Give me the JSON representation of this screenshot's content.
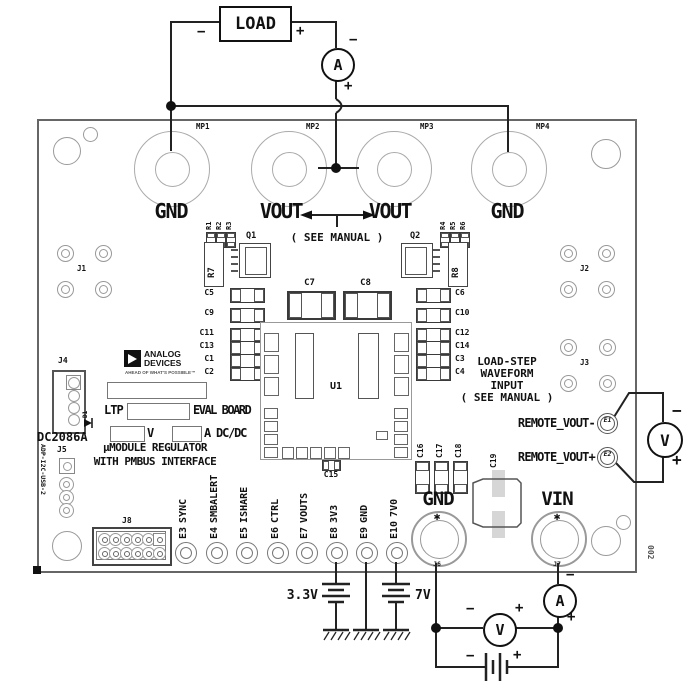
{
  "external_circuit": {
    "load_label": "LOAD",
    "load_minus": "−",
    "load_plus": "+",
    "top_ammeter": {
      "letter": "A",
      "minus": "−",
      "plus": "+"
    },
    "remote_voltmeter": {
      "letter": "V",
      "minus": "−",
      "plus": "+"
    },
    "input_voltmeter": {
      "letter": "V",
      "minus": "−",
      "plus": "+"
    },
    "input_ammeter": {
      "letter": "A",
      "minus": "−",
      "plus": "+"
    },
    "input_battery": {
      "minus": "−",
      "plus": "+"
    },
    "rail_33": "3.3V",
    "rail_7": "7V"
  },
  "board": {
    "rev": "002",
    "power_terminals": [
      {
        "ref": "MP1",
        "label": "GND"
      },
      {
        "ref": "MP2",
        "label": "VOUT"
      },
      {
        "ref": "MP3",
        "label": "VOUT"
      },
      {
        "ref": "MP4",
        "label": "GND"
      }
    ],
    "see_manual": "( SEE MANUAL )",
    "resistors_left": [
      "R1",
      "R2",
      "R3"
    ],
    "resistors_right": [
      "R4",
      "R5",
      "R6"
    ],
    "q1": "Q1",
    "q2": "Q2",
    "r7": "R7",
    "r8": "R8",
    "caps_left": [
      "C5",
      "C9",
      "C11",
      "C13",
      "C1",
      "C2"
    ],
    "caps_right": [
      "C6",
      "C10",
      "C12",
      "C14",
      "C3",
      "C4"
    ],
    "c7": "C7",
    "c8": "C8",
    "u1": "U1",
    "c15": "C15",
    "caps_input": [
      "C16",
      "C17",
      "C18"
    ],
    "c19": "C19",
    "j1": "J1",
    "j2": "J2",
    "j3": "J3",
    "j4": "J4",
    "j5": "J5",
    "j8": "J8",
    "dc_number": "DC2086A",
    "d1": "D1",
    "dongle_label": "ADP-I2C-USB-2",
    "logo": {
      "name1": "ANALOG",
      "name2": "DEVICES",
      "tagline": "AHEAD OF WHAT'S POSSIBLE™"
    },
    "ltp": "LTP",
    "eval_board": "EVAL BOARD",
    "volts_suffix": "V",
    "amps_suffix": "A DC/DC",
    "title1": "µMODULE REGULATOR",
    "title2": "WITH PMBUS INTERFACE",
    "loadstep": {
      "l1": "LOAD-STEP",
      "l2": "WAVEFORM",
      "l3": "INPUT",
      "l4": "( SEE MANUAL )"
    },
    "remote_minus": {
      "label": "REMOTE_VOUT-",
      "ref": "E1"
    },
    "remote_plus": {
      "label": "REMOTE_VOUT+",
      "ref": "E2"
    },
    "testpoints": [
      {
        "ref": "E3",
        "label": "SYNC"
      },
      {
        "ref": "E4",
        "label": "SMBALERT"
      },
      {
        "ref": "E5",
        "label": "ISHARE"
      },
      {
        "ref": "E6",
        "label": "CTRL"
      },
      {
        "ref": "E7",
        "label": "VOUTS"
      },
      {
        "ref": "E8",
        "label": "3V3"
      },
      {
        "ref": "E9",
        "label": "GND"
      },
      {
        "ref": "E10",
        "label": "7V0"
      }
    ],
    "input_terminals": [
      {
        "ref": "J6",
        "label": "GND",
        "star": "✱"
      },
      {
        "ref": "J7",
        "label": "VIN",
        "star": "✱"
      }
    ]
  }
}
